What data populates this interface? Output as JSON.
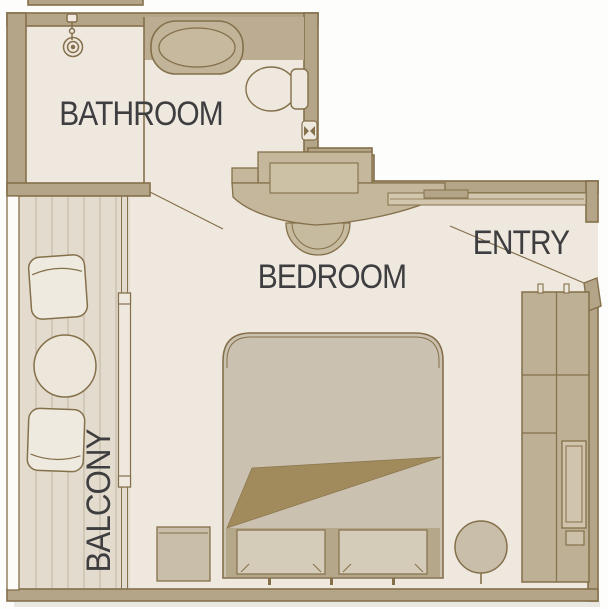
{
  "rooms": {
    "bathroom": "BATHROOM",
    "bedroom": "BEDROOM",
    "entry": "ENTRY",
    "balcony": "BALCONY"
  },
  "fixtures": [
    "shower-icon",
    "bathtub-icon",
    "toilet-icon",
    "tissue-holder-icon",
    "vanity-desk",
    "vanity-stool",
    "entry-door",
    "door-swing-line",
    "wardrobe",
    "minibar-fridge",
    "bed",
    "pillows",
    "blanket-fold",
    "nightstand",
    "round-stool",
    "balcony-table",
    "balcony-chair",
    "sliding-glass-door",
    "balcony-railing",
    "deck-planks"
  ],
  "colors": {
    "outside_background": "#fdfdfb",
    "floor": "#efe8df",
    "wall_fill": "#b4a588",
    "wall_outline": "#84704a",
    "furniture_fill": "#c9bea9",
    "bed_fill": "#cbc1b0",
    "pillow_fill": "#d5cbb9",
    "blanket_fold": "#a18b5d",
    "deck_fill": "#e3dbcd",
    "deck_plank_line": "#c0b5a1",
    "label_text": "#3e3e40"
  }
}
